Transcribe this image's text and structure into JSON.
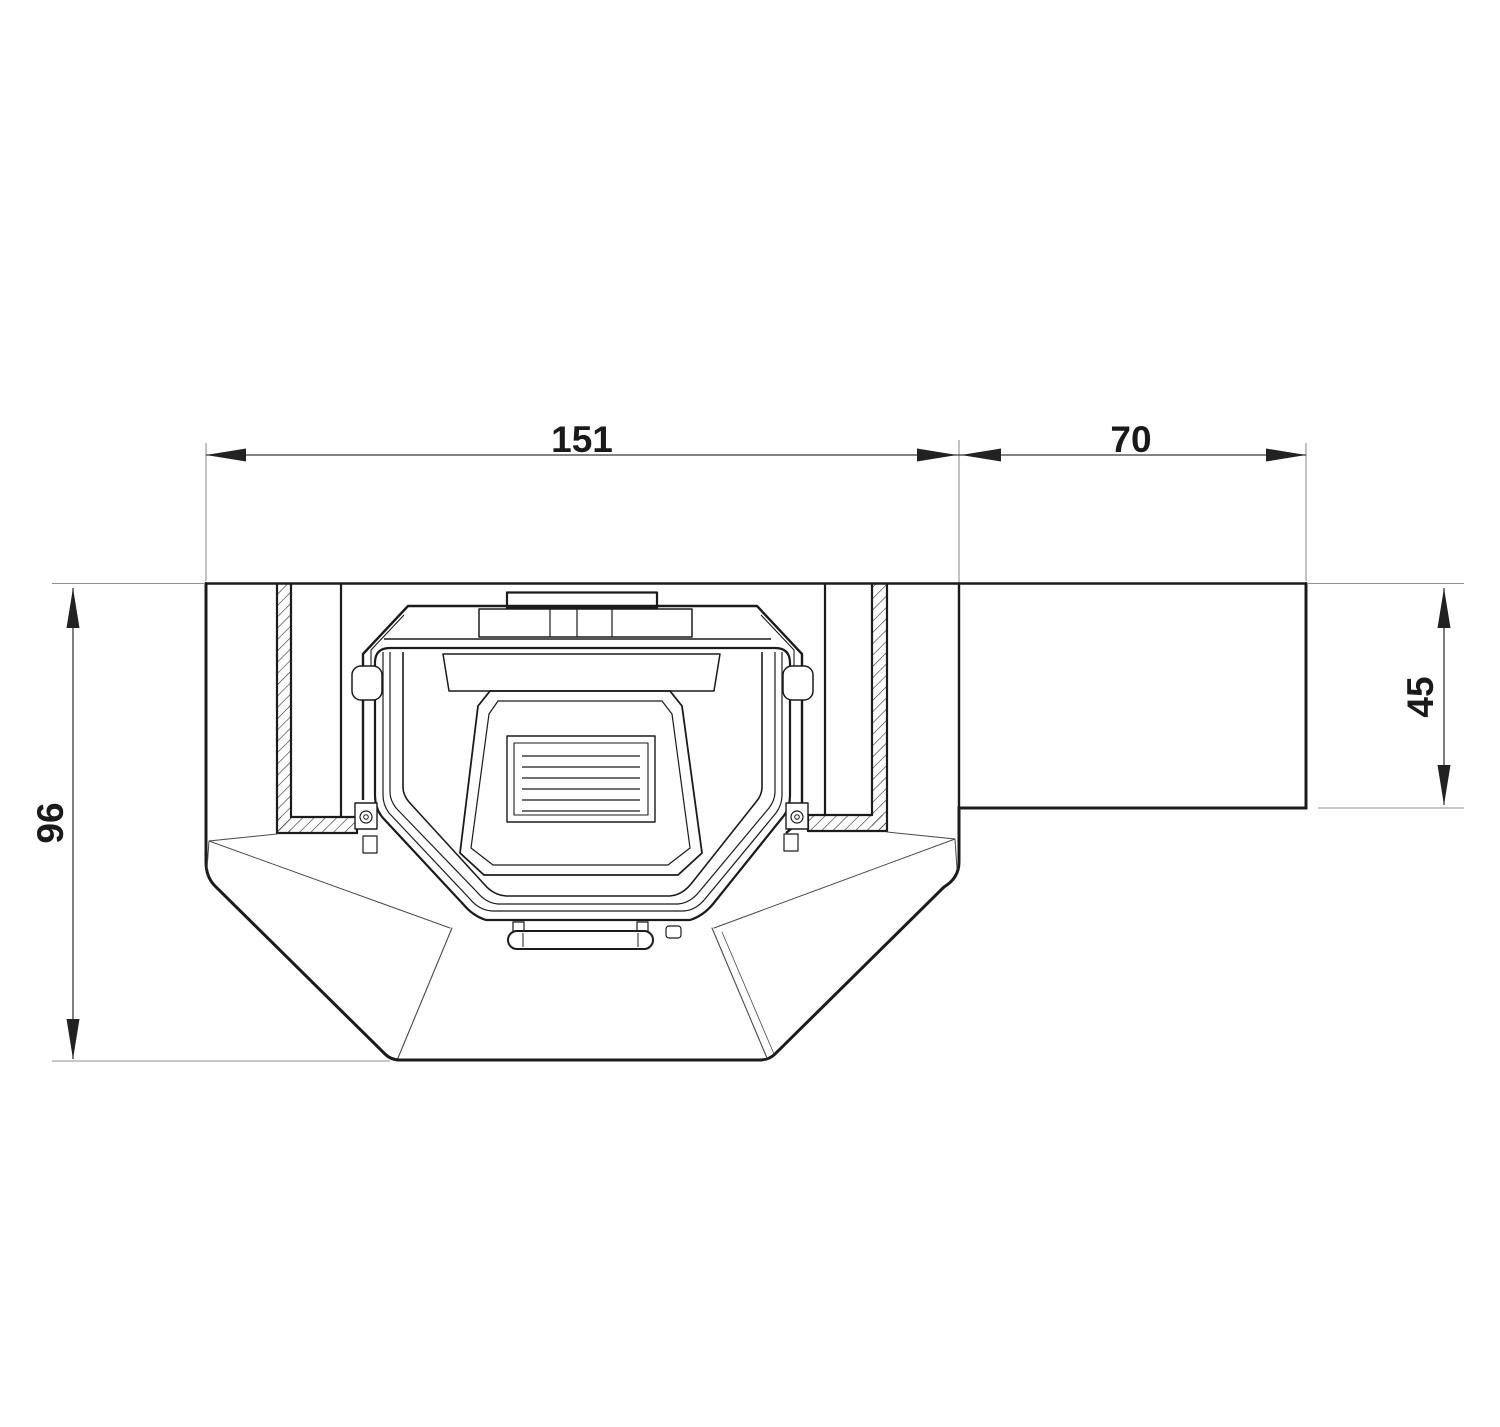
{
  "drawing": {
    "kind": "technical-plan-view-fireplace-insert",
    "dimension_labels": {
      "niche_width": "151",
      "side_extension_width": "70",
      "overall_depth": "96",
      "side_extension_depth": "45"
    },
    "colors": {
      "background": "#ffffff",
      "structure_line": "#1b1b1b",
      "dimension_line": "#3a3a3a",
      "extension_line": "#8f8f8f",
      "text": "#1a1a1a"
    }
  }
}
